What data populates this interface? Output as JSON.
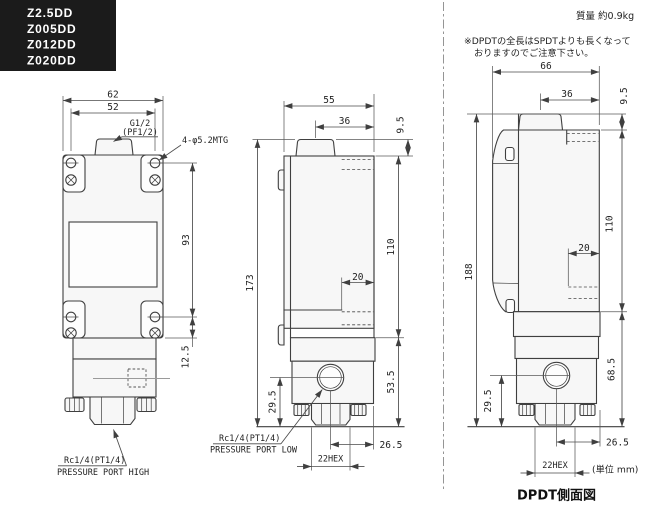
{
  "header": {
    "models": [
      "Z2.5DD",
      "Z005DD",
      "Z012DD",
      "Z020DD"
    ],
    "mass_label": "質量 約0.9kg",
    "note_line1": "※DPDTの全長はSPDTよりも長くなって",
    "note_line2": "おりますのでご注意下さい。"
  },
  "front_view": {
    "width": "62",
    "hole_span": "52",
    "conduit_thread": "G1/2",
    "conduit_thread_alt": "(PF1/2)",
    "mounting_holes": "4-φ5.2MTG",
    "hole_pitch_vertical": "93",
    "bottom_offset": "12.5",
    "port_thread": "Rc1/4(PT1/4)",
    "port_label": "PRESSURE PORT HIGH"
  },
  "spdt_side_view": {
    "depth": "55",
    "conduit_to_back": "36",
    "boss_height": "9.5",
    "total_height": "173",
    "body_height": "110",
    "terminal_depth": "20",
    "lower_height": "53.5",
    "port_center_height": "29.5",
    "port_to_back": "26.5",
    "hex_size": "22HEX",
    "port_thread": "Rc1/4(PT1/4)",
    "port_label": "PRESSURE PORT LOW"
  },
  "dpdt_side_view": {
    "depth": "66",
    "conduit_to_back": "36",
    "boss_height": "9.5",
    "total_height": "188",
    "body_height": "110",
    "terminal_depth": "20",
    "lower_height": "68.5",
    "port_center_height": "29.5",
    "port_to_back": "26.5",
    "hex_size": "22HEX"
  },
  "footer": {
    "unit_note": "(単位 mm)",
    "dpdt_title": "DPDT側面図"
  }
}
